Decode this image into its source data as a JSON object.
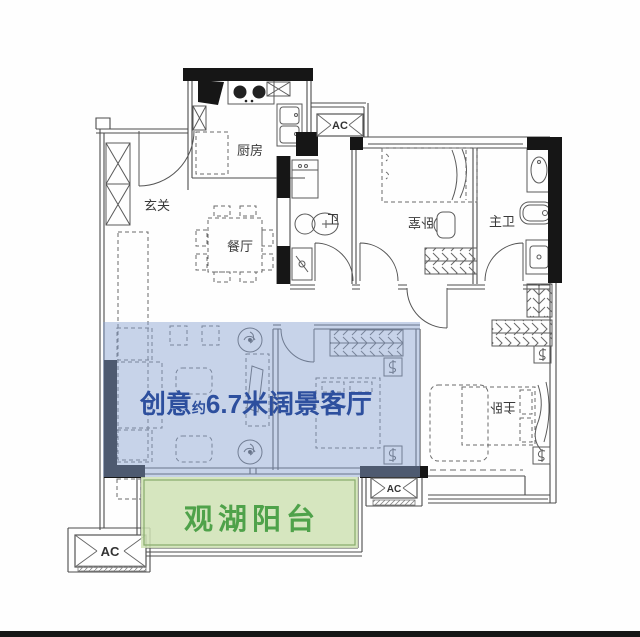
{
  "plan": {
    "rooms": {
      "entry": {
        "label": "玄关"
      },
      "kitchen": {
        "label": "厨房"
      },
      "dining": {
        "label": "餐厅"
      },
      "bath": {
        "label": "卫"
      },
      "bedroom": {
        "label": "卧室"
      },
      "master_bath": {
        "label": "主卫"
      },
      "master_bedroom": {
        "label": "主卧"
      }
    },
    "highlights": {
      "living_room": {
        "text_prefix": "创意",
        "text_small": "约",
        "text_main": "6.7米阔景客厅",
        "fill": "#8da5d4",
        "text_color": "#2d4f9e"
      },
      "balcony": {
        "label": "观湖阳台",
        "fill": "#cfe2b4",
        "border": "#86ab6b",
        "text_color": "#4fa24a"
      }
    },
    "ac_units": [
      {
        "id": "top",
        "label": "AC"
      },
      {
        "id": "bottom-left",
        "label": "AC"
      },
      {
        "id": "bottom-right",
        "label": "AC"
      }
    ],
    "wall_color": "#161616",
    "line_color": "#4c4c4c",
    "bottom_bar_color": "#161616"
  }
}
